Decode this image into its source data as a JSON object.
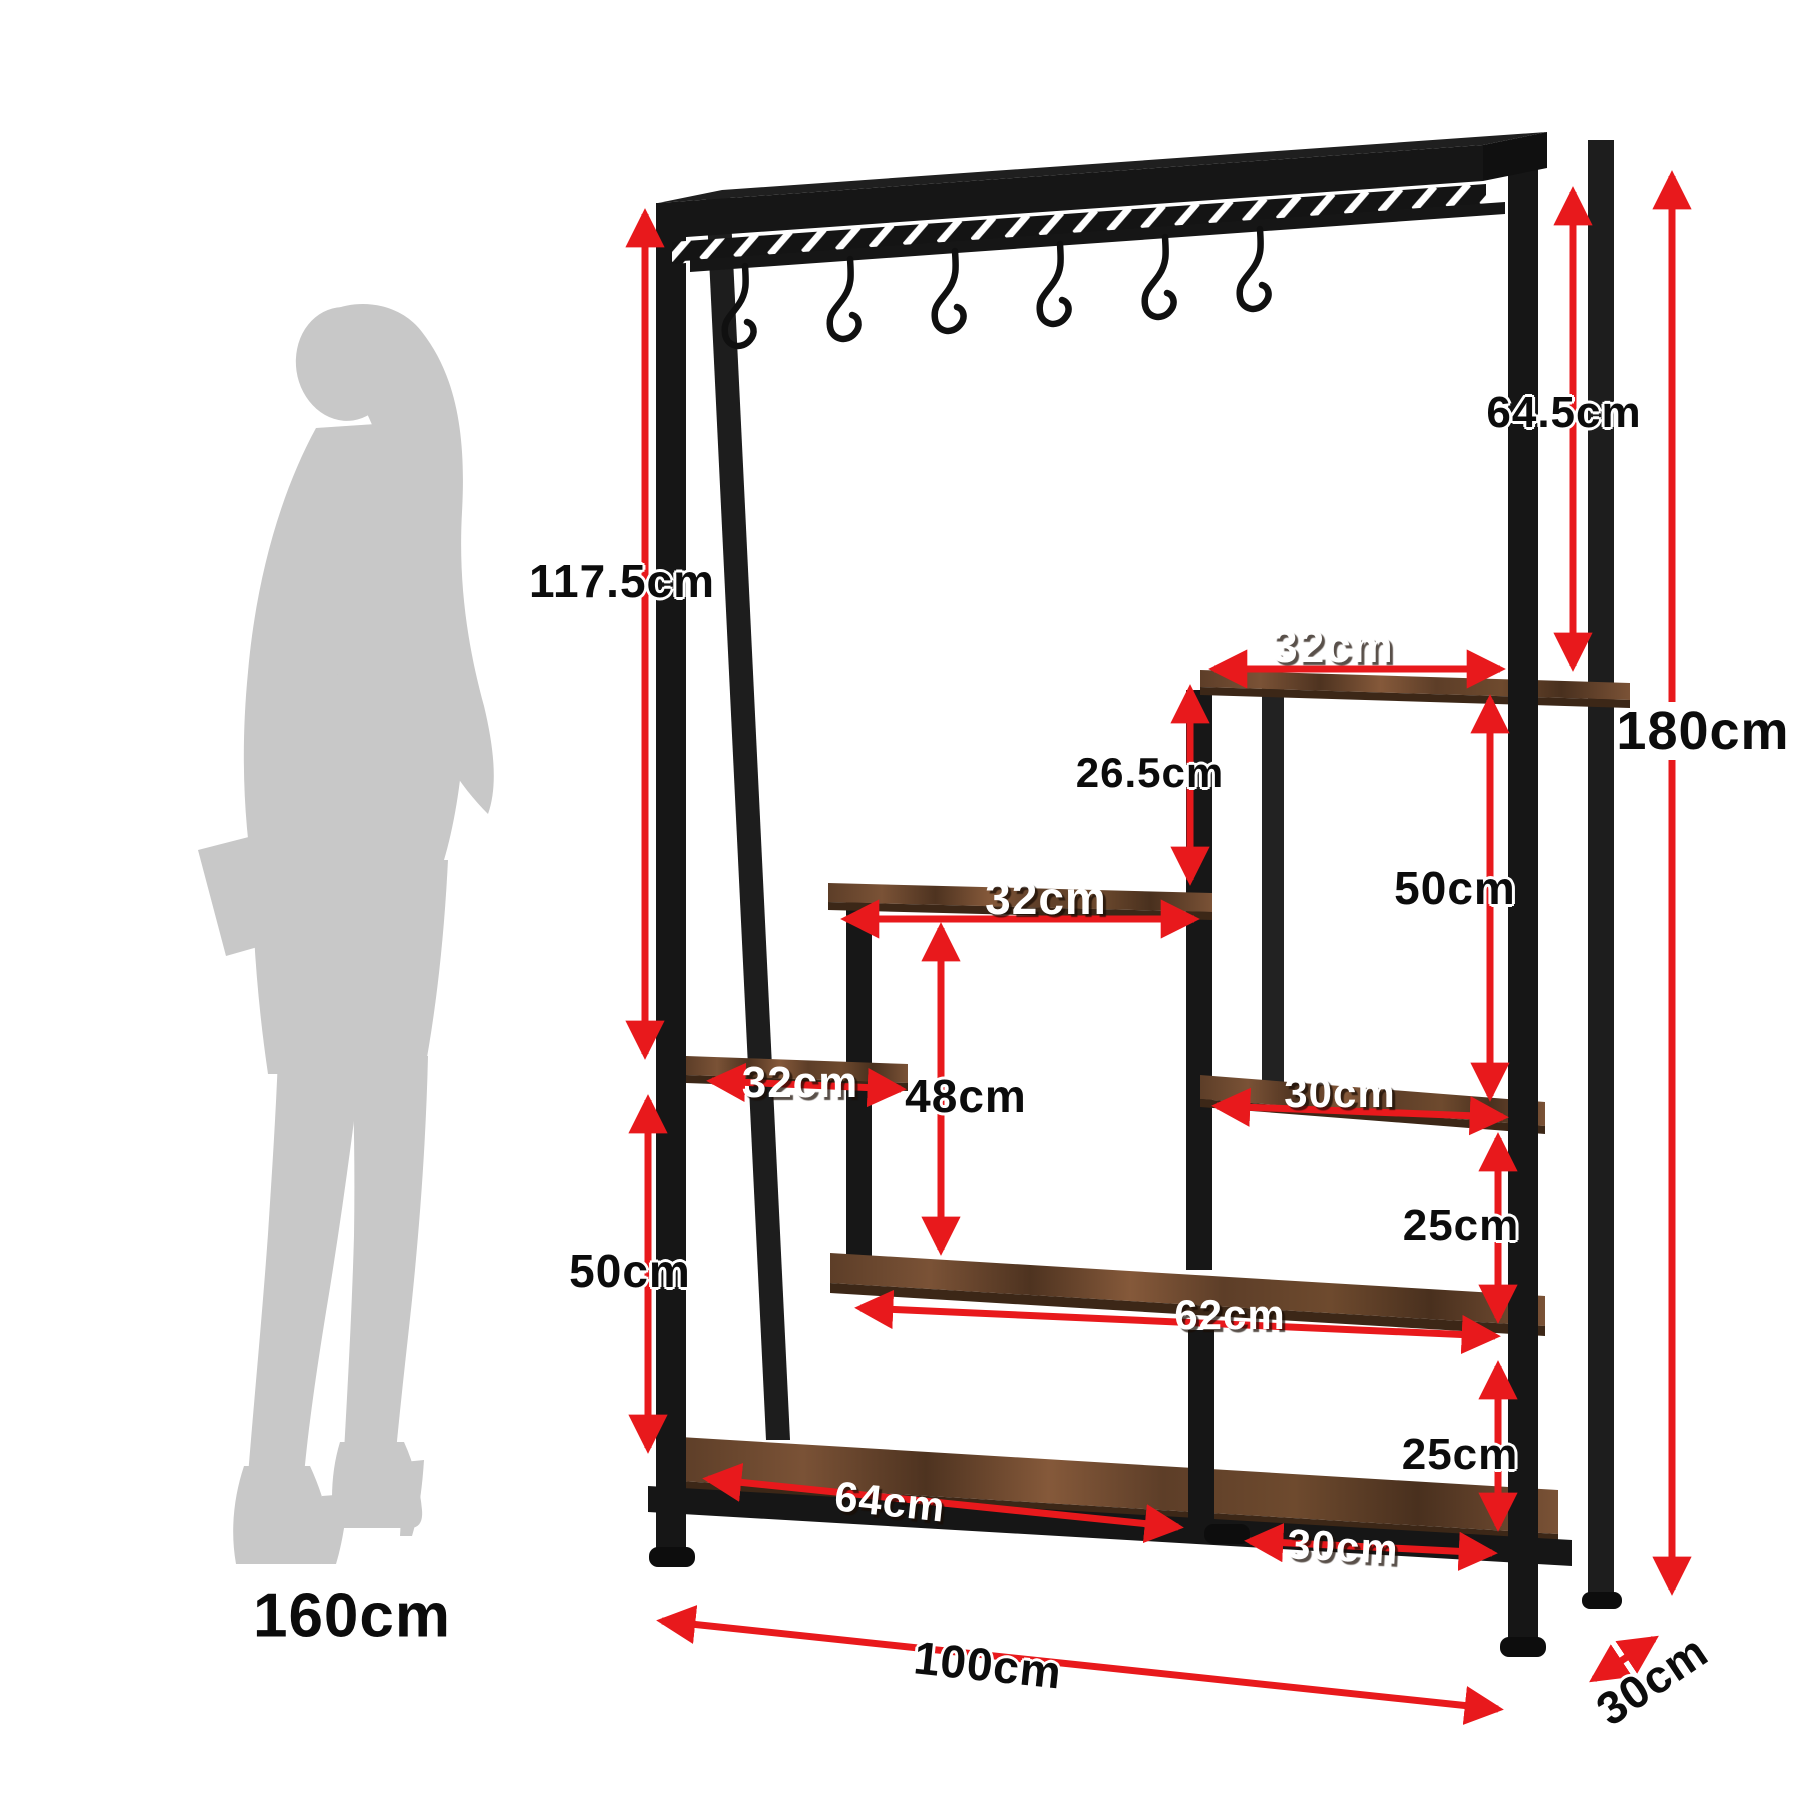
{
  "diagram": {
    "type": "furniture-dimension-diagram",
    "product": "industrial metal plant stand shelf with hanging hooks",
    "hook_count": 6,
    "shelf_count": 6
  },
  "colors": {
    "dimension_red": "#e8191c",
    "metal_black": "#161616",
    "wood_brown": "#6e4a2e",
    "silhouette_gray": "#c8c8c8",
    "background": "#ffffff"
  },
  "labels": {
    "hang_height": "117.5cm",
    "left_bottom_gap": "50cm",
    "right_top_gap": "64.5cm",
    "step_gap": "26.5cm",
    "right_upper_column": "50cm",
    "middle_column": "48cm",
    "right_gap_upper": "25cm",
    "right_gap_lower": "25cm",
    "total_height": "180cm",
    "top_shelf_width": "32cm",
    "middle_shelf_width": "32cm",
    "left_shelf_width": "32cm",
    "right_shelf_width": "30cm",
    "long_shelf_width": "62cm",
    "bottom_shelf_width": "64cm",
    "bottom_right_shelf_width": "30cm",
    "total_width": "100cm",
    "depth": "30cm",
    "human_height": "160cm"
  }
}
